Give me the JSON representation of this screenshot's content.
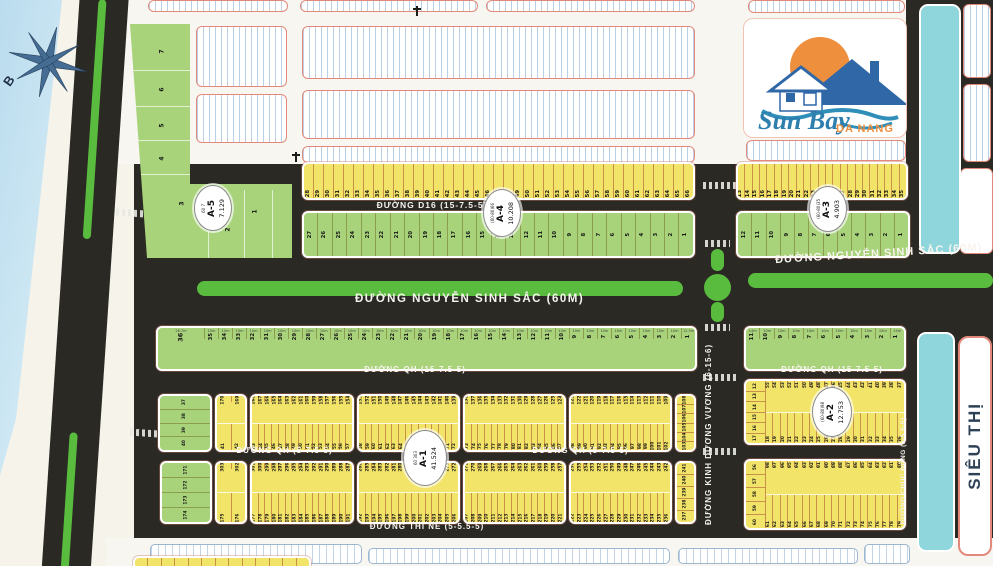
{
  "map": {
    "compass": "B",
    "sieu_thi": "SIÊU THỊ",
    "logo": {
      "name": "Sun Bay",
      "city": "DA NANG"
    },
    "streets": {
      "ntt": "Đ. NGUYỄN TẤT THÀNH (10-10.5-4-10.5-10)",
      "d16": "ĐƯỜNG D16  (15-7.5-5)",
      "nss": "ĐƯỜNG NGUYỄN SINH SẮC (60M)",
      "qh15": "ĐƯỜNG QH  (15-7.5-5)",
      "qh5": "ĐƯỜNG QH  (5-7.5-5)",
      "thine": "ĐƯỜNG THI NẼ  (5-5.5-5)",
      "kdv": "ĐƯỜNG KINH DƯƠNG VƯƠNG (6-15-6)",
      "chucdong": "ĐƯỜNG CHÚC ĐỘNG (5-5.5-5)"
    },
    "circles": [
      {
        "id": "A-5",
        "top": "60  7",
        "value": "7.129",
        "cx": 212,
        "cy": 207,
        "w": 36,
        "h": 44
      },
      {
        "id": "A-4",
        "top": "(60-80)66",
        "value": "10.208",
        "cx": 501,
        "cy": 212,
        "w": 36,
        "h": 46
      },
      {
        "id": "A-3",
        "top": "(60-80)35",
        "value": "4.903",
        "cx": 827,
        "cy": 208,
        "w": 36,
        "h": 44
      },
      {
        "id": "A-1",
        "top": "60  303",
        "value": "41.524",
        "cx": 424,
        "cy": 457,
        "w": 42,
        "h": 54
      },
      {
        "id": "A-2",
        "top": "(60-80)98",
        "value": "12.753",
        "cx": 831,
        "cy": 411,
        "w": 38,
        "h": 48
      }
    ],
    "a5_lots": [
      {
        "n": "7",
        "x": 40,
        "y": 24
      },
      {
        "n": "6",
        "x": 40,
        "y": 62
      },
      {
        "n": "5",
        "x": 40,
        "y": 98
      },
      {
        "n": "4",
        "x": 40,
        "y": 131
      },
      {
        "n": "3",
        "x": 60,
        "y": 176
      },
      {
        "n": "2",
        "x": 106,
        "y": 202
      },
      {
        "n": "1",
        "x": 133,
        "y": 184
      }
    ],
    "strips": [
      {
        "id": "d16-north",
        "x": 302,
        "y": 162,
        "w": 393,
        "h": 38,
        "bg": "Y",
        "kind": "row",
        "numpos": "bottom",
        "nums": [
          {
            "a": 28,
            "b": 66
          }
        ]
      },
      {
        "id": "a3-north",
        "x": 736,
        "y": 162,
        "w": 172,
        "h": 38,
        "bg": "Y",
        "kind": "row",
        "numpos": "bottom",
        "nums": [
          {
            "a": 13,
            "b": 35
          }
        ]
      },
      {
        "id": "a4-green",
        "x": 302,
        "y": 211,
        "w": 393,
        "h": 47,
        "bg": "G",
        "kind": "row",
        "numpos": "middle",
        "nums": [
          {
            "a": 27,
            "b": 1
          }
        ]
      },
      {
        "id": "a3-green",
        "x": 736,
        "y": 211,
        "w": 174,
        "h": 47,
        "bg": "G",
        "kind": "row",
        "numpos": "middle",
        "nums": [
          {
            "a": 12,
            "b": 1
          }
        ]
      },
      {
        "id": "nss-south",
        "x": 156,
        "y": 326,
        "w": 541,
        "h": 45,
        "bg": "G",
        "kind": "row",
        "numpos": "top",
        "bigFirst": 46,
        "nums": [
          36,
          {
            "a": 35,
            "b": 1
          }
        ],
        "dims": {
          "first": "28.7m",
          "repeat": "10m",
          "last": "12.5m"
        }
      },
      {
        "id": "nss-south-r",
        "x": 744,
        "y": 326,
        "w": 162,
        "h": 45,
        "bg": "G",
        "kind": "row",
        "numpos": "top",
        "nums": [
          {
            "a": 11,
            "b": 1
          }
        ],
        "dims": {
          "first": "14m",
          "repeat": "10m",
          "last": "14m"
        }
      },
      {
        "id": "b1-green",
        "x": 158,
        "y": 394,
        "w": 54,
        "h": 58,
        "bg": "G",
        "kind": "vcol",
        "nums": [
          37,
          38,
          39,
          40
        ]
      },
      {
        "id": "b1-colA",
        "x": 215,
        "y": 394,
        "w": 32,
        "h": 58,
        "bg": "Y",
        "kind": "band",
        "top": [
          170,
          169
        ],
        "bottom": [
          41,
          42
        ]
      },
      {
        "id": "b1-1",
        "x": 250,
        "y": 394,
        "w": 104,
        "h": 58,
        "bg": "Y",
        "kind": "band",
        "top": [
          {
            "a": 168,
            "b": 154
          }
        ],
        "bottom": [
          {
            "a": 43,
            "b": 57
          }
        ]
      },
      {
        "id": "b1-2",
        "x": 357,
        "y": 394,
        "w": 103,
        "h": 58,
        "bg": "Y",
        "kind": "band",
        "top": [
          {
            "a": 153,
            "b": 139
          }
        ],
        "bottom": [
          {
            "a": 58,
            "b": 72
          }
        ]
      },
      {
        "id": "b1-3",
        "x": 463,
        "y": 394,
        "w": 103,
        "h": 58,
        "bg": "Y",
        "kind": "band",
        "top": [
          {
            "a": 138,
            "b": 124
          }
        ],
        "bottom": [
          {
            "a": 73,
            "b": 87
          }
        ]
      },
      {
        "id": "b1-4",
        "x": 569,
        "y": 394,
        "w": 103,
        "h": 58,
        "bg": "Y",
        "kind": "band",
        "top": [
          {
            "a": 123,
            "b": 109
          }
        ],
        "bottom": [
          {
            "a": 88,
            "b": 102
          }
        ]
      },
      {
        "id": "b1-colR",
        "x": 675,
        "y": 394,
        "w": 21,
        "h": 58,
        "bg": "Y",
        "kind": "vcol",
        "nums": [
          108,
          107,
          106,
          105,
          104,
          103
        ]
      },
      {
        "id": "b2-green",
        "x": 160,
        "y": 461,
        "w": 52,
        "h": 63,
        "bg": "G",
        "kind": "vcol",
        "nums": [
          171,
          172,
          173,
          174
        ]
      },
      {
        "id": "b2-colA",
        "x": 215,
        "y": 461,
        "w": 32,
        "h": 63,
        "bg": "Y",
        "kind": "band",
        "top": [
          303,
          302
        ],
        "bottom": [
          175,
          176
        ]
      },
      {
        "id": "b2-1",
        "x": 250,
        "y": 461,
        "w": 104,
        "h": 63,
        "bg": "Y",
        "kind": "band",
        "top": [
          {
            "a": 301,
            "b": 287
          }
        ],
        "bottom": [
          {
            "a": 177,
            "b": 191
          }
        ]
      },
      {
        "id": "b2-2",
        "x": 357,
        "y": 461,
        "w": 103,
        "h": 63,
        "bg": "Y",
        "kind": "band",
        "top": [
          {
            "a": 286,
            "b": 272
          }
        ],
        "bottom": [
          {
            "a": 192,
            "b": 206
          }
        ]
      },
      {
        "id": "b2-3",
        "x": 463,
        "y": 461,
        "w": 103,
        "h": 63,
        "bg": "Y",
        "kind": "band",
        "top": [
          {
            "a": 271,
            "b": 257
          }
        ],
        "bottom": [
          {
            "a": 207,
            "b": 221
          }
        ]
      },
      {
        "id": "b2-4",
        "x": 569,
        "y": 461,
        "w": 103,
        "h": 63,
        "bg": "Y",
        "kind": "band",
        "top": [
          {
            "a": 256,
            "b": 242
          }
        ],
        "bottom": [
          {
            "a": 222,
            "b": 236
          }
        ]
      },
      {
        "id": "b2-colR",
        "x": 675,
        "y": 461,
        "w": 21,
        "h": 63,
        "bg": "Y",
        "kind": "vcol",
        "nums": [
          241,
          240,
          239,
          238,
          237
        ]
      },
      {
        "id": "a2",
        "x": 744,
        "y": 379,
        "w": 162,
        "h": 66,
        "bg": "Y",
        "kind": "band",
        "left": [
          12,
          13,
          14,
          15,
          16,
          17
        ],
        "top": [
          {
            "a": 55,
            "b": 37
          }
        ],
        "bottom": [
          {
            "a": 18,
            "b": 36
          }
        ]
      },
      {
        "id": "br",
        "x": 744,
        "y": 459,
        "w": 162,
        "h": 71,
        "bg": "Y",
        "kind": "band",
        "left": [
          56,
          57,
          58,
          59,
          60
        ],
        "top": [
          {
            "a": 98,
            "b": 80
          }
        ],
        "bottom": [
          {
            "a": 61,
            "b": 79
          }
        ]
      },
      {
        "id": "bottom-partial",
        "x": 133,
        "y": 556,
        "w": 178,
        "h": 14,
        "bg": "Y",
        "kind": "row",
        "numpos": "middle",
        "count": 13,
        "nums": []
      }
    ]
  }
}
